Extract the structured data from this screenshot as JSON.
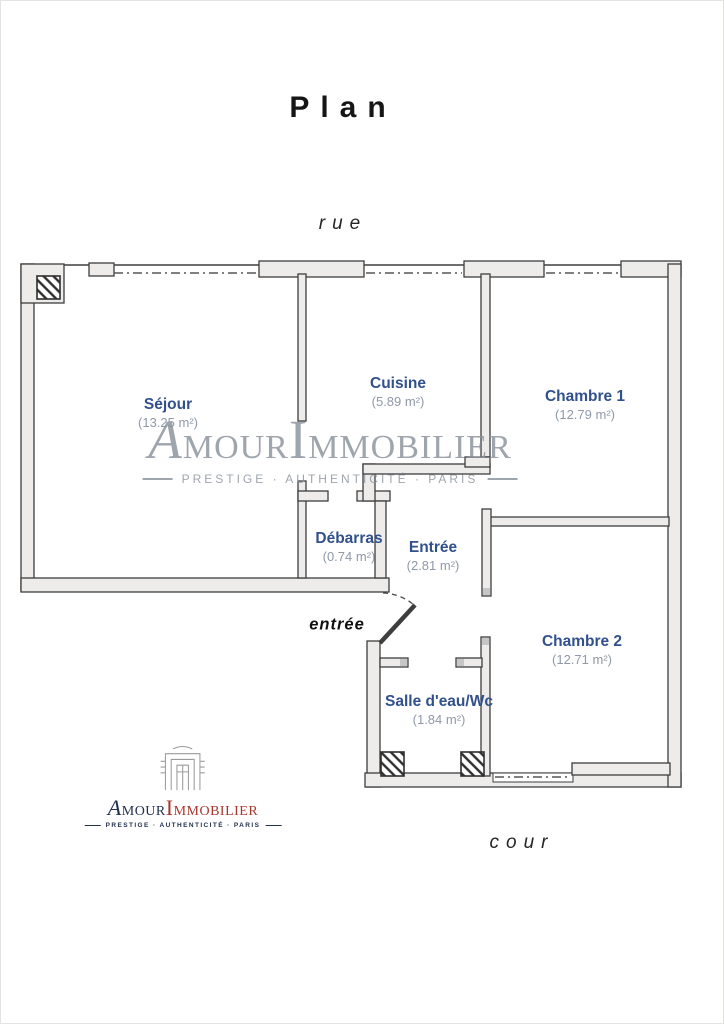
{
  "labels": {
    "title": "Plan",
    "street": "rue",
    "courtyard": "cour",
    "entrance": "entrée"
  },
  "rooms": [
    {
      "name": "Séjour",
      "area_label": "(13.25 m²)",
      "area_m2": 13.25
    },
    {
      "name": "Cuisine",
      "area_label": "(5.89 m²)",
      "area_m2": 5.89
    },
    {
      "name": "Chambre 1",
      "area_label": "(12.79 m²)",
      "area_m2": 12.79
    },
    {
      "name": "Débarras",
      "area_label": "(0.74 m²)",
      "area_m2": 0.74
    },
    {
      "name": "Entrée",
      "area_label": "(2.81 m²)",
      "area_m2": 2.81
    },
    {
      "name": "Chambre 2",
      "area_label": "(12.71 m²)",
      "area_m2": 12.71
    },
    {
      "name": "Salle d'eau/Wc",
      "area_label": "(1.84 m²)",
      "area_m2": 1.84
    }
  ],
  "watermark": {
    "brand_part1": "Amour",
    "brand_part2": "Immobilier",
    "tagline": "PRESTIGE · AUTHENTICITÉ · PARIS"
  },
  "logo": {
    "brand_part1": "Amour",
    "brand_part2": "Immobilier",
    "tagline": "PRESTIGE · AUTHENTICITÉ · PARIS"
  },
  "colors": {
    "room_name": "#31508c",
    "room_area": "#8f99a8",
    "wall_stroke": "#3e3e3e",
    "wall_fill": "#edecea",
    "watermark_gray": "#8a929b",
    "logo_navy": "#22304f",
    "logo_red": "#a8372e"
  }
}
